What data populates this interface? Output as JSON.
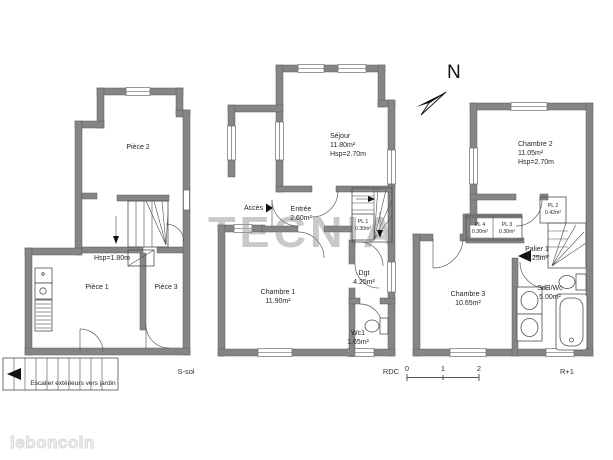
{
  "branding": {
    "logo_text": "leboncoin",
    "watermark_text": "TECNIA"
  },
  "compass": {
    "north_label": "N"
  },
  "scale_bar": {
    "tick_0": "0",
    "tick_1": "1",
    "tick_2": "2"
  },
  "floors": {
    "ssol": {
      "floor_label": "S-sol",
      "piece2": {
        "name": "Pièce 2"
      },
      "piece1": {
        "name": "Pièce 1"
      },
      "piece3": {
        "name": "Pièce 3"
      },
      "ceiling_note": "Hsp=1.80m",
      "exterior_stairs_note": "Escalier extérieurs vers jardin"
    },
    "rdc": {
      "floor_label": "RDC",
      "access_label": "Accès",
      "sejour": {
        "name": "Séjour",
        "area": "11.80m²",
        "ceiling": "Hsp=2.70m"
      },
      "entree": {
        "name": "Entrée",
        "area": "2.60m²"
      },
      "pl1": {
        "name": "PL 1",
        "area": "0.30m²"
      },
      "chambre1": {
        "name": "Chambre 1",
        "area": "11.90m²"
      },
      "dgt": {
        "name": "Dgt",
        "area": "4.25m²"
      },
      "wc1": {
        "name": "Wc1",
        "area": "1.65m²"
      }
    },
    "r1": {
      "floor_label": "R+1",
      "chambre2": {
        "name": "Chambre 2",
        "area": "11.05m²",
        "ceiling": "Hsp=2.70m"
      },
      "pl2": {
        "name": "PL 2",
        "area": "0.42m²"
      },
      "pl4": {
        "name": "PL 4",
        "area": "0.30m²"
      },
      "pl3": {
        "name": "PL 3",
        "area": "0.30m²"
      },
      "palier1": {
        "name": "Palier 1",
        "area": "1.25m²"
      },
      "chambre3": {
        "name": "Chambre 3",
        "area": "10.65m²"
      },
      "sdb": {
        "name": "SdB/Wc",
        "area": "5.00m²"
      }
    }
  },
  "colors": {
    "wall": "#858585",
    "line": "#4f4f4f",
    "watermark": "#c9c9c9"
  }
}
